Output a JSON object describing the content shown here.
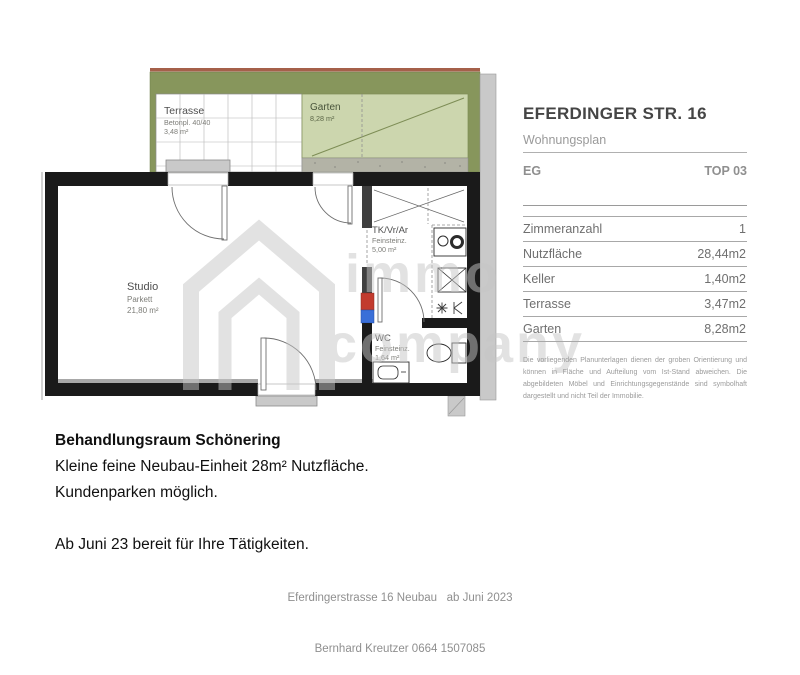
{
  "colors": {
    "terrain-red": "#a5604a",
    "green-dark": "#87965c",
    "green-light": "#ccd6ae",
    "gravel": "#b3b3a6",
    "wall": "#1a1a1a",
    "interior-wall": "#3f3f3f",
    "plumbing-hot": "#c23b2e",
    "plumbing-cold": "#3a6fd8",
    "watermark": "#c6c6c6"
  },
  "panel": {
    "title": "EFERDINGER STR. 16",
    "subtitle": "Wohnungsplan",
    "floor": "EG",
    "unit": "TOP 03",
    "table": {
      "rows": [
        {
          "label": "Zimmeranzahl",
          "value": "1"
        },
        {
          "label": "Nutzfläche",
          "value": "28,44m2"
        },
        {
          "label": "Keller",
          "value": "1,40m2"
        },
        {
          "label": "Terrasse",
          "value": "3,47m2"
        },
        {
          "label": "Garten",
          "value": "8,28m2"
        }
      ]
    },
    "disclaimer": "Die vorliegenden Planunterlagen dienen der groben Orientierung und können in Fläche und Aufteilung vom Ist-Stand abweichen. Die abgebildeten Möbel und Einrichtungsgegenstände sind symbolhaft dargestellt und nicht Teil der Immobilie."
  },
  "plan": {
    "terrasse": {
      "name": "Terrasse",
      "detail": "Betonpl. 40/40",
      "area": "3,48 m²"
    },
    "garten": {
      "name": "Garten",
      "area": "8,28 m²"
    },
    "studio": {
      "name": "Studio",
      "floor": "Parkett",
      "area": "21,80 m²"
    },
    "vorraum": {
      "name": "TK/Vr/Ar",
      "floor": "Feinsteinz.",
      "area": "5,00 m²"
    },
    "wc": {
      "name": "WC",
      "floor": "Feinsteinz.",
      "area": "1,64 m²"
    }
  },
  "watermark": {
    "word1": "immo",
    "word2": "company"
  },
  "description": {
    "title": "Behandlungsraum Schönering",
    "line2": "Kleine feine Neubau-Einheit 28m² Nutzfläche.",
    "line3": "Kundenparken möglich.",
    "line4": "Ab Juni 23 bereit für Ihre Tätigkeiten."
  },
  "footer": {
    "line1": "Eferdingerstrasse 16 Neubau   ab Juni 2023",
    "line2": "Bernhard Kreutzer 0664 1507085"
  }
}
